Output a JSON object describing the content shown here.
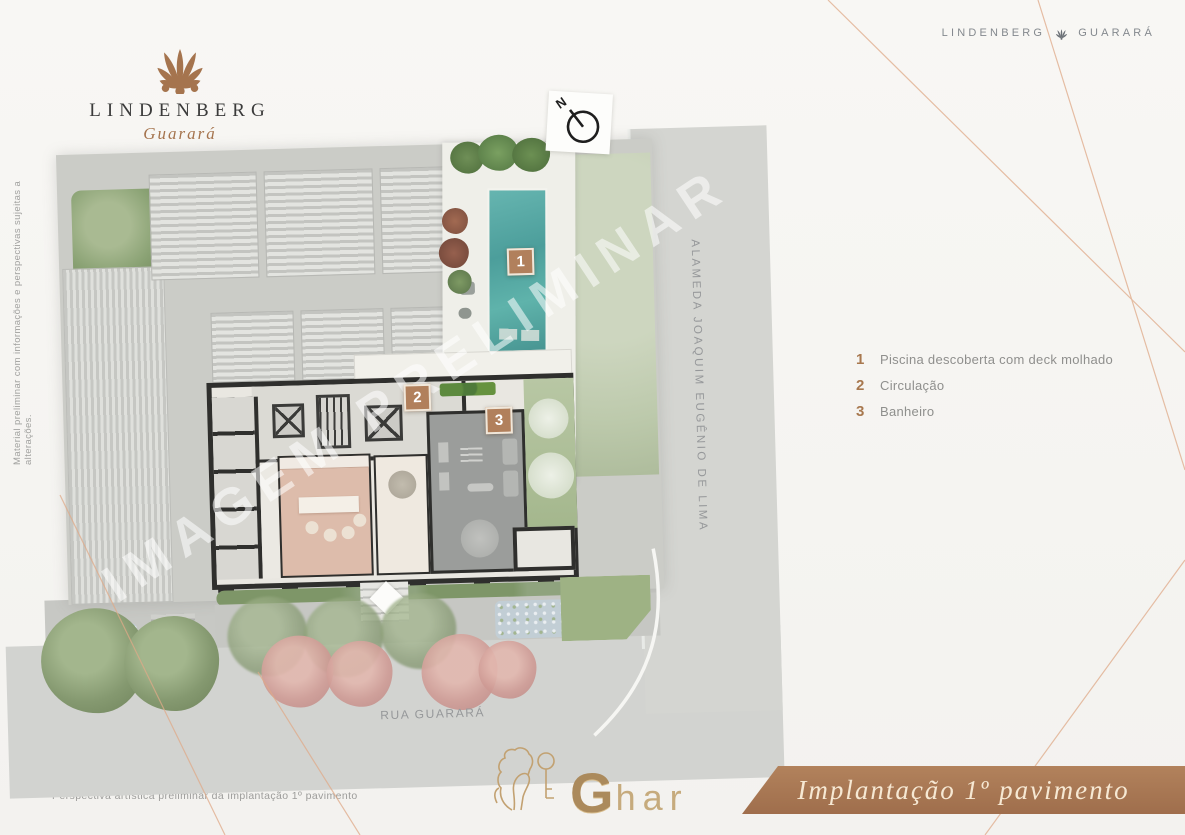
{
  "header": {
    "logo": {
      "title": "LINDENBERG",
      "subtitle": "Guarará"
    },
    "brand_line": {
      "left": "LINDENBERG",
      "right": "GUARARÁ"
    }
  },
  "legend": {
    "items": [
      {
        "number": "1",
        "label": "Piscina descoberta com deck molhado"
      },
      {
        "number": "2",
        "label": "Circulação"
      },
      {
        "number": "3",
        "label": "Banheiro"
      }
    ]
  },
  "plan": {
    "watermark": "IMAGEM PRELIMINAR",
    "north_label": "N",
    "streets": {
      "right_vertical": "ALAMEDA JOAQUIM EUGÊNIO DE LIMA",
      "bottom": "RUA GUARARÁ"
    }
  },
  "footer": {
    "caption": "Perspectiva artística preliminar da implantação 1º pavimento",
    "banner_title": "Implantação 1º pavimento",
    "ghar": {
      "g": "G",
      "rest": "har"
    }
  },
  "side_note": "Material preliminar com informações e perspectivas sujeitas a alterações.",
  "icons": {
    "brand": "palmette-icon",
    "north": "north-arrow-icon",
    "ghar": "lion-key-icon"
  },
  "colors": {
    "brand_brown": "#a5744e",
    "banner": "#aa7a56",
    "marker": "#b1805c",
    "copper_line": "#dfa988",
    "pool": "#4fa8a4",
    "text_gray": "#8f9092",
    "paper": "#f7f6f3"
  }
}
